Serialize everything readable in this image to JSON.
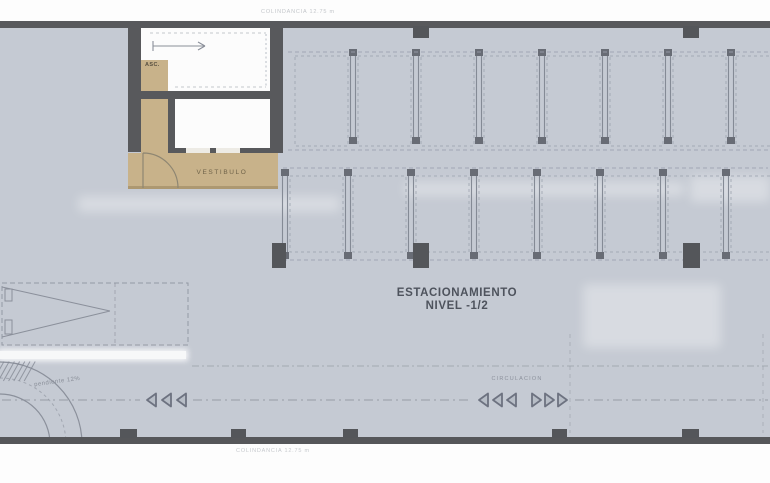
{
  "plan": {
    "title_line1": "ESTACIONAMIENTO",
    "title_line2": "NIVEL -1/2",
    "vestibule_label": "VESTIBULO",
    "elevator_label": "ASC.",
    "circulation_label": "CIRCULACION",
    "ramp_slope_label": "pendiente 12%",
    "boundary_top_label": "COLINDANCIA 12.75 m",
    "boundary_bottom_label": "COLINDANCIA 12.75 m",
    "circulation_arrows": {
      "left_outer_count": 3,
      "left_inner_count": 3,
      "right_inner_count": 3
    }
  },
  "colors": {
    "floor": "#c5cad3",
    "wall": "#58595c",
    "vestibule_fill": "#c8b28a",
    "room_fill": "#fcfcfc",
    "line": "#8b909b",
    "stall_line": "#9ba2ae",
    "text_dark": "#4e535d",
    "text_muted": "#8d929d"
  }
}
